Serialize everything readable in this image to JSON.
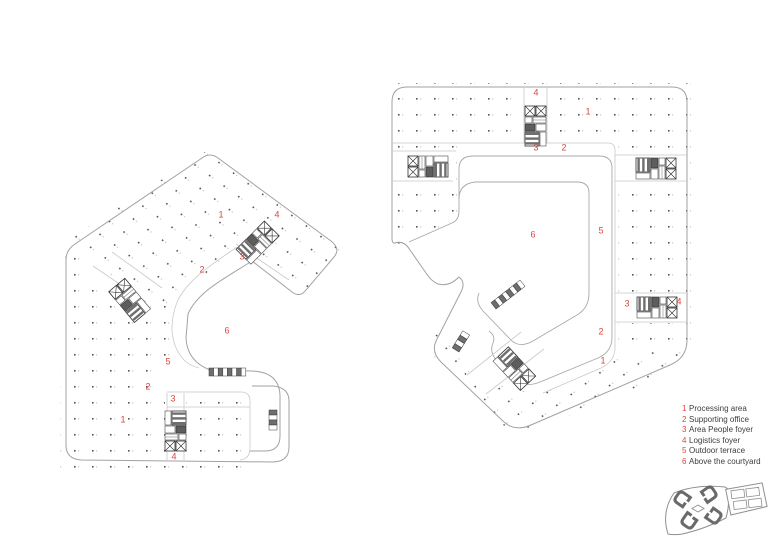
{
  "drawing": {
    "kind": "architectural floor plans",
    "background": "#ffffff"
  },
  "colors": {
    "accent_red": "#d8473c",
    "outline_gray": "#a2a2a2",
    "thin_line_gray": "#c9c9c9",
    "dot_gray": "#555555",
    "core_dark": "#303030",
    "legend_text": "#3d3d3d"
  },
  "legend": {
    "items": [
      {
        "num": "1",
        "label": "Processing area"
      },
      {
        "num": "2",
        "label": "Supporting office"
      },
      {
        "num": "3",
        "label": "Area People foyer"
      },
      {
        "num": "4",
        "label": "Logistics foyer"
      },
      {
        "num": "5",
        "label": "Outdoor terrace"
      },
      {
        "num": "6",
        "label": "Above the courtyard"
      }
    ]
  },
  "plans": [
    {
      "id": "left",
      "name": "floor-plan-left",
      "labels": [
        {
          "num": "1",
          "x": 221,
          "y": 215
        },
        {
          "num": "4",
          "x": 277,
          "y": 215
        },
        {
          "num": "3",
          "x": 242,
          "y": 257
        },
        {
          "num": "2",
          "x": 202,
          "y": 270
        },
        {
          "num": "6",
          "x": 227,
          "y": 331
        },
        {
          "num": "5",
          "x": 168,
          "y": 362
        },
        {
          "num": "2",
          "x": 148,
          "y": 387
        },
        {
          "num": "3",
          "x": 173,
          "y": 399
        },
        {
          "num": "1",
          "x": 123,
          "y": 420
        },
        {
          "num": "4",
          "x": 174,
          "y": 457
        }
      ]
    },
    {
      "id": "right",
      "name": "floor-plan-right",
      "labels": [
        {
          "num": "4",
          "x": 536,
          "y": 93
        },
        {
          "num": "1",
          "x": 588,
          "y": 112
        },
        {
          "num": "3",
          "x": 536,
          "y": 148
        },
        {
          "num": "2",
          "x": 564,
          "y": 148
        },
        {
          "num": "6",
          "x": 533,
          "y": 235
        },
        {
          "num": "5",
          "x": 601,
          "y": 231
        },
        {
          "num": "3",
          "x": 627,
          "y": 304
        },
        {
          "num": "4",
          "x": 679,
          "y": 302
        },
        {
          "num": "2",
          "x": 601,
          "y": 332
        },
        {
          "num": "1",
          "x": 603,
          "y": 361
        }
      ]
    }
  ],
  "key_plan": {
    "description": "site key plan with four building footprints and annex blocks"
  }
}
